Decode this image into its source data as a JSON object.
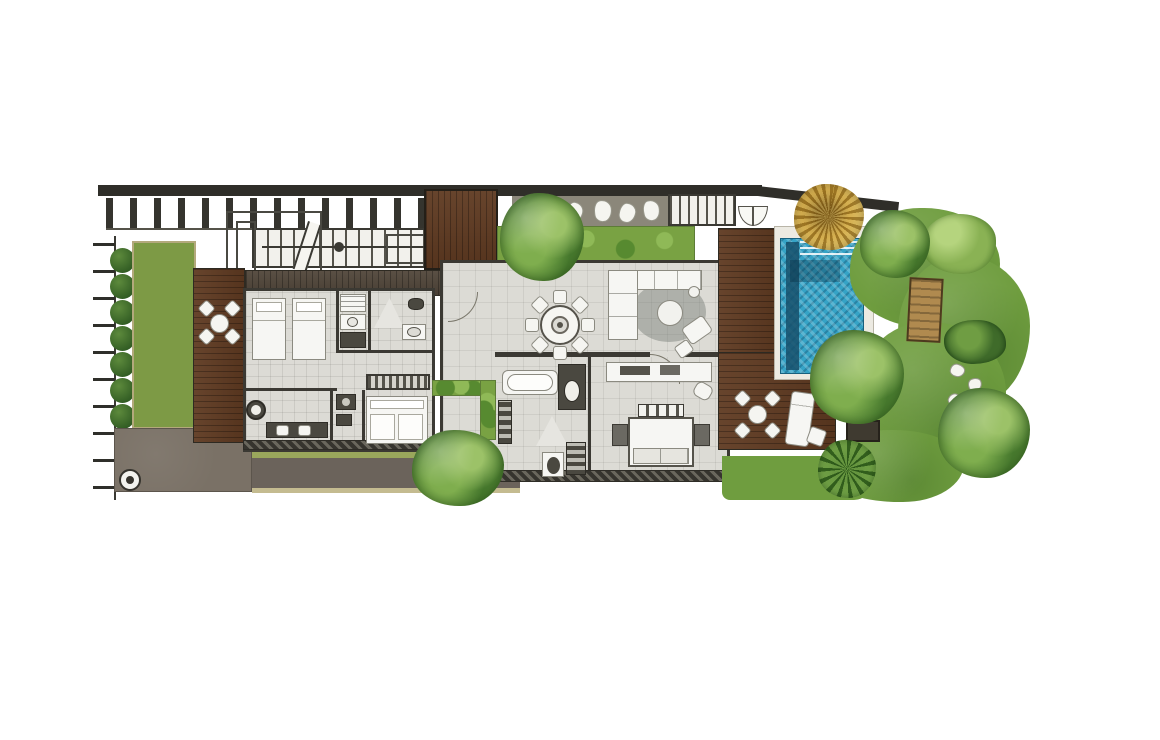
{
  "image_type": "top-down architectural floor plan of a one-storey pool villa, illustrated site plan, no text labels visible",
  "palette": {
    "background": "#ffffff",
    "wall": "#2f2e29",
    "floor_tile": "#dcdbd5",
    "deck_wood": "#5f3a21",
    "walkway_wood": "#51463a",
    "lawn": "#7d9a45",
    "lawn_band": "#9aa75c",
    "path_dark": "#6b635b",
    "plaza": "#7a7166",
    "tan_edge": "#c4bb90",
    "planter_green": "#79a243",
    "garden_grass": "#6f9d3f",
    "tree_green": "#5e8f3a",
    "tree_gold": "#c79b35",
    "hedge_green": "#3f6b2a",
    "pool_water": "#35a3c6",
    "pool_lane": "#16506b",
    "furniture_white": "#f6f6f3",
    "stone_strip": "#8b877a"
  },
  "features": {
    "site": [
      "boundary-wall",
      "pergola-posts",
      "boundary-ticks",
      "hedge-row",
      "side-lawn",
      "gravel-plaza",
      "water-jar-ornament",
      "lawn-band",
      "garden-path",
      "stepping-stones"
    ],
    "circulation": [
      "main-staircase",
      "upper-staircase",
      "entry-deck",
      "double-door",
      "door-swings"
    ],
    "interior": [
      "twin-bedroom",
      "kitchenette",
      "guest-shower-room",
      "hallway",
      "wardrobe",
      "foyer-vanity",
      "utility-room",
      "daybed-room",
      "dining-area",
      "living-area",
      "master-bathroom",
      "master-bedroom"
    ],
    "interior_items": [
      "twin-bed",
      "dining-table-8-chairs",
      "l-shaped-sofa",
      "coffee-table",
      "round-rug",
      "armchair",
      "ottoman",
      "double-bed",
      "nightstand",
      "desk",
      "bathtub",
      "vanity-basin",
      "shower",
      "toilet"
    ],
    "outdoor": [
      "left-courtyard-deck",
      "deck-dining-set",
      "pool-deck",
      "sun-lounger",
      "swimming-pool",
      "pool-steps",
      "lap-lane",
      "tropical-garden",
      "garden-trees",
      "golden-tree",
      "palm-tree",
      "grass-mound",
      "wooden-garden-lounger",
      "tree-planter-box"
    ]
  }
}
